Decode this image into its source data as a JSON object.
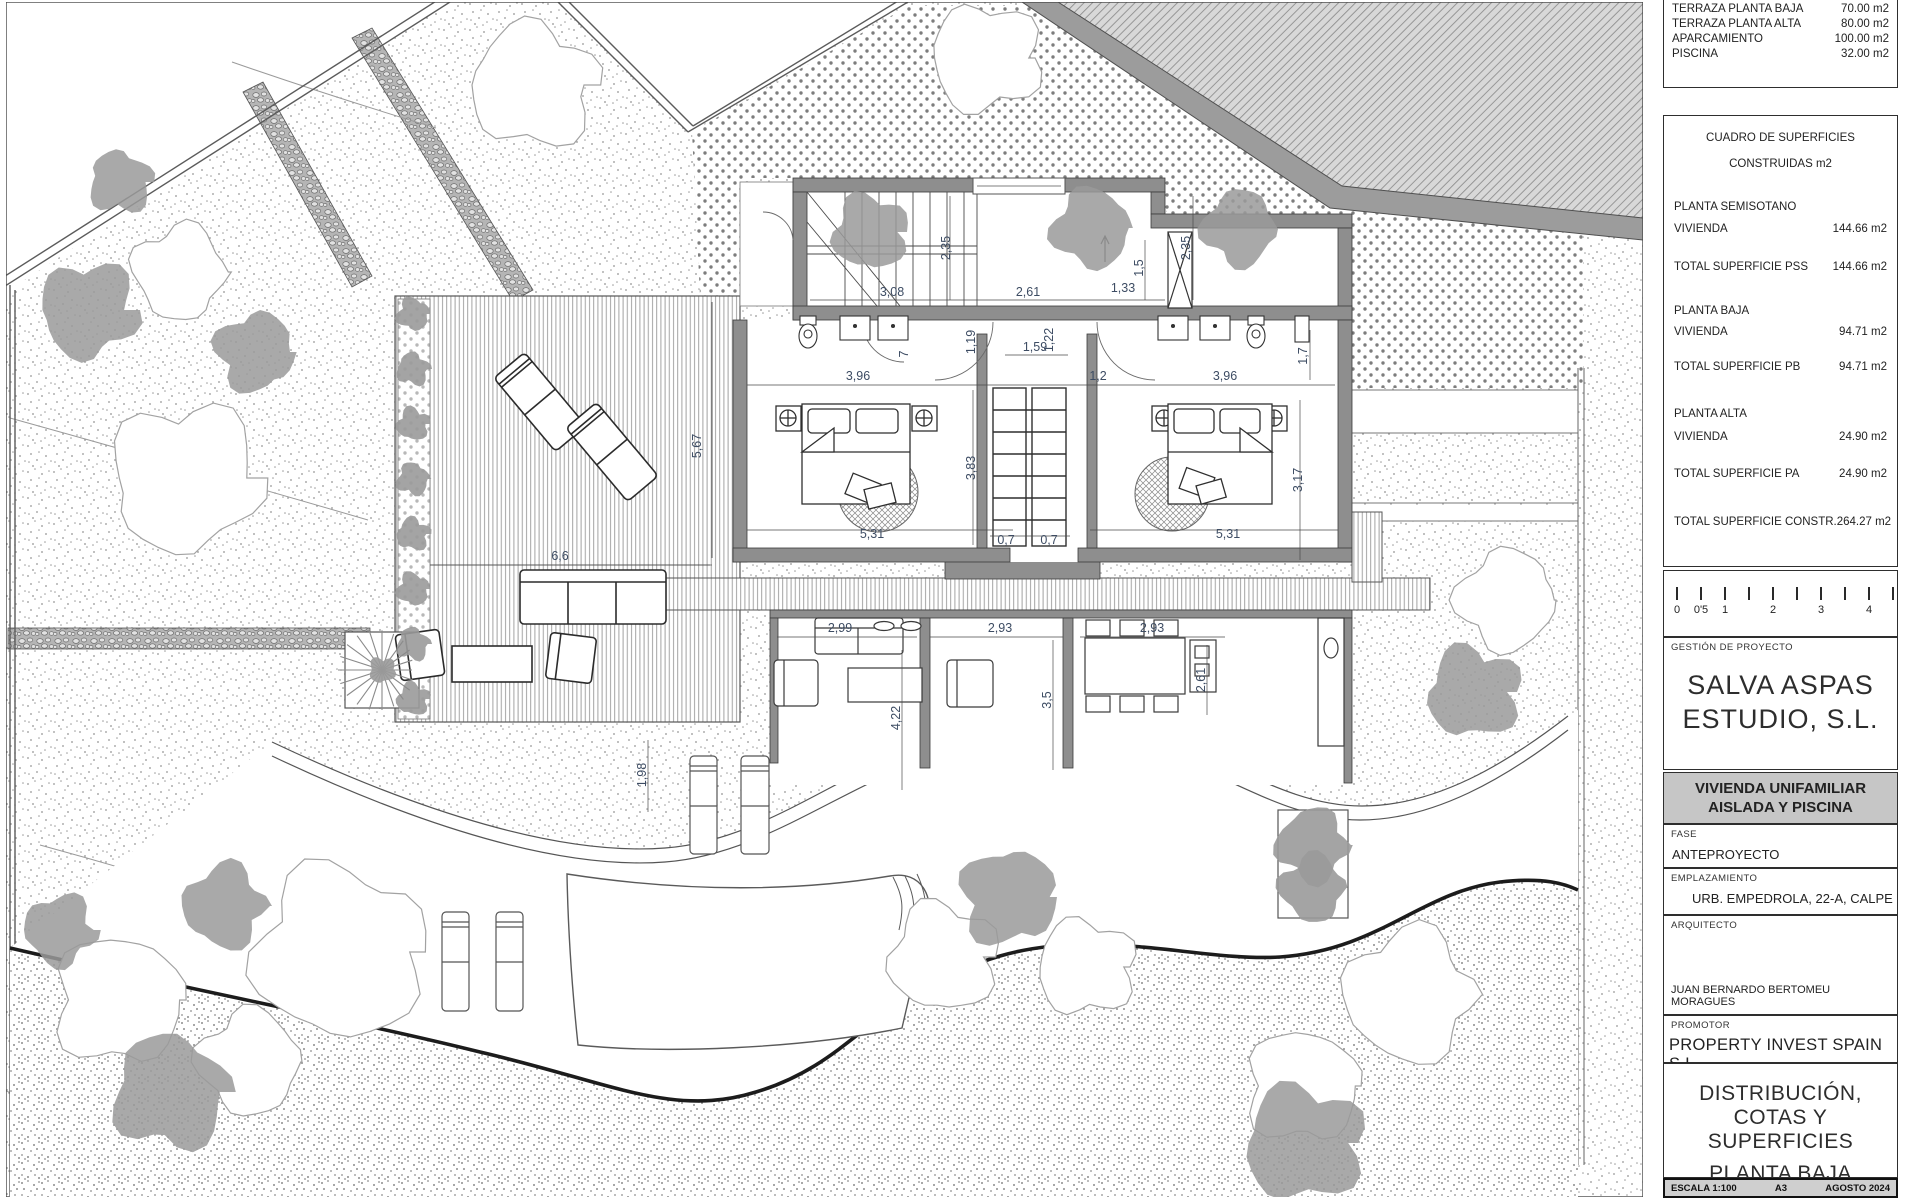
{
  "sheet": {
    "terrace_table": {
      "rows": [
        {
          "label": "TERRAZA PLANTA BAJA",
          "value": "70.00 m2"
        },
        {
          "label": "TERRAZA PLANTA ALTA",
          "value": "80.00 m2"
        },
        {
          "label": "APARCAMIENTO",
          "value": "100.00 m2"
        },
        {
          "label": "PISCINA",
          "value": "32.00 m2"
        }
      ]
    },
    "surfaces": {
      "title1": "CUADRO DE SUPERFICIES",
      "title2": "CONSTRUIDAS m2",
      "groups": [
        {
          "heading": "PLANTA SEMISOTANO",
          "row_label": "VIVIENDA",
          "row_value": "144.66 m2",
          "total_label": "TOTAL SUPERFICIE PSS",
          "total_value": "144.66 m2"
        },
        {
          "heading": "PLANTA BAJA",
          "row_label": "VIVIENDA",
          "row_value": "94.71 m2",
          "total_label": "TOTAL SUPERFICIE PB",
          "total_value": "94.71 m2"
        },
        {
          "heading": "PLANTA ALTA",
          "row_label": "VIVIENDA",
          "row_value": "24.90 m2",
          "total_label": "TOTAL SUPERFICIE PA",
          "total_value": "24.90 m2"
        }
      ],
      "grand_total_label": "TOTAL SUPERFICIE CONSTR.",
      "grand_total_value": "264.27 m2"
    },
    "scalebar": {
      "labels": [
        "0",
        "0'5",
        "1",
        "2",
        "3",
        "4"
      ]
    },
    "management": {
      "label": "GESTIÓN DE PROYECTO",
      "name_line1": "SALVA ASPAS",
      "name_line2": "ESTUDIO, S.L."
    },
    "project": {
      "line1": "VIVIENDA UNIFAMILIAR",
      "line2": "AISLADA Y PISCINA"
    },
    "fase": {
      "label": "FASE",
      "value": "ANTEPROYECTO"
    },
    "emplazamiento": {
      "label": "EMPLAZAMIENTO",
      "value": "URB. EMPEDROLA, 22-A, CALPE"
    },
    "arquitecto": {
      "label": "ARQUITECTO",
      "value": "JUAN BERNARDO BERTOMEU MORAGUES"
    },
    "promotor": {
      "label": "PROMOTOR",
      "value": "PROPERTY INVEST SPAIN S.L."
    },
    "drawing_title": {
      "line1": "DISTRIBUCIÓN,",
      "line2": "COTAS Y SUPERFICIES",
      "line3": "PLANTA BAJA"
    },
    "footer": {
      "escala": "ESCALA 1:100",
      "formato": "A3",
      "fecha": "AGOSTO 2024"
    }
  },
  "plan": {
    "dimensions": [
      {
        "t": "3,08",
        "x": 892,
        "y": 296,
        "r": 0
      },
      {
        "t": "2,35",
        "x": 950,
        "y": 248,
        "r": -90
      },
      {
        "t": "2,61",
        "x": 1028,
        "y": 296,
        "r": 0
      },
      {
        "t": "2,35",
        "x": 1190,
        "y": 248,
        "r": -90
      },
      {
        "t": "1,33",
        "x": 1123,
        "y": 292,
        "r": 0
      },
      {
        "t": "1,5",
        "x": 1143,
        "y": 268,
        "r": -90
      },
      {
        "t": "1,19",
        "x": 975,
        "y": 342,
        "r": -90
      },
      {
        "t": "1,59",
        "x": 1035,
        "y": 351,
        "r": 0
      },
      {
        "t": "1,22",
        "x": 1053,
        "y": 340,
        "r": -90
      },
      {
        "t": "7",
        "x": 908,
        "y": 354,
        "r": -90
      },
      {
        "t": "3,96",
        "x": 858,
        "y": 380,
        "r": 0
      },
      {
        "t": "1,2",
        "x": 1098,
        "y": 380,
        "r": 0
      },
      {
        "t": "3,96",
        "x": 1225,
        "y": 380,
        "r": 0
      },
      {
        "t": "1,7",
        "x": 1307,
        "y": 356,
        "r": -90
      },
      {
        "t": "3,83",
        "x": 975,
        "y": 468,
        "r": -90
      },
      {
        "t": "3,17",
        "x": 1302,
        "y": 480,
        "r": -90
      },
      {
        "t": "5,31",
        "x": 872,
        "y": 538,
        "r": 0
      },
      {
        "t": "0,7",
        "x": 1006,
        "y": 544,
        "r": 0
      },
      {
        "t": "0,7",
        "x": 1049,
        "y": 544,
        "r": 0
      },
      {
        "t": "5,31",
        "x": 1228,
        "y": 538,
        "r": 0
      },
      {
        "t": "5,67",
        "x": 701,
        "y": 446,
        "r": -90
      },
      {
        "t": "6,6",
        "x": 560,
        "y": 560,
        "r": 0
      },
      {
        "t": "2,99",
        "x": 840,
        "y": 632,
        "r": 0
      },
      {
        "t": "2,93",
        "x": 1000,
        "y": 632,
        "r": 0
      },
      {
        "t": "2,93",
        "x": 1152,
        "y": 632,
        "r": 0
      },
      {
        "t": "2,61",
        "x": 1205,
        "y": 680,
        "r": -90
      },
      {
        "t": "4,22",
        "x": 900,
        "y": 718,
        "r": -90
      },
      {
        "t": "3,5",
        "x": 1051,
        "y": 700,
        "r": -90
      },
      {
        "t": "1,98",
        "x": 646,
        "y": 775,
        "r": -90
      }
    ]
  }
}
